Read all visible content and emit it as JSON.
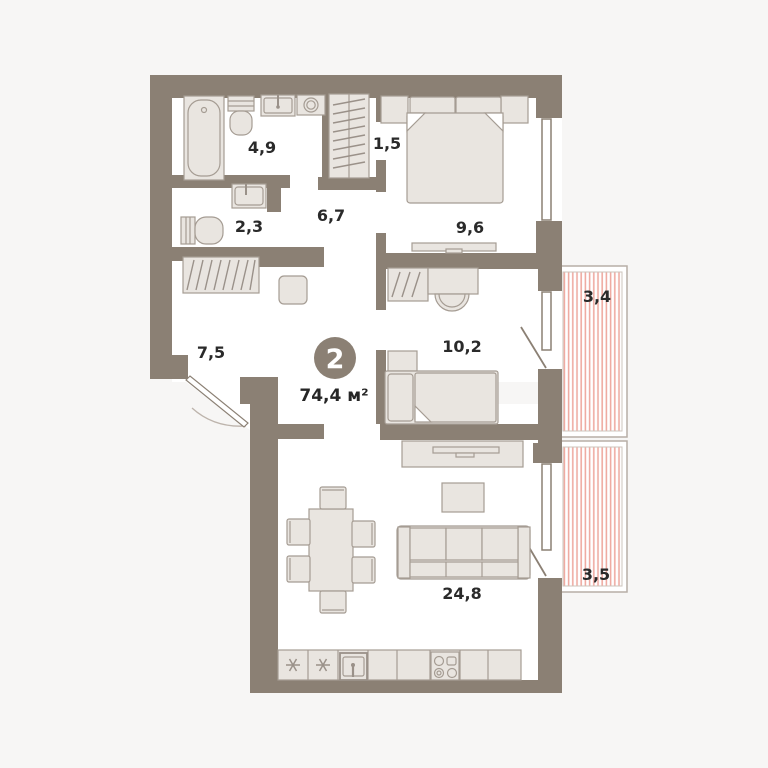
{
  "plan": {
    "badge_number": "2",
    "total_area": "74,4 м²",
    "rooms": [
      {
        "name": "bathroom",
        "area_label": "4,9"
      },
      {
        "name": "closet",
        "area_label": "1,5"
      },
      {
        "name": "wc",
        "area_label": "2,3"
      },
      {
        "name": "corridor",
        "area_label": "6,7"
      },
      {
        "name": "bedroom",
        "area_label": "9,6"
      },
      {
        "name": "hallway",
        "area_label": "7,5"
      },
      {
        "name": "kids-room",
        "area_label": "10,2"
      },
      {
        "name": "living-kitchen",
        "area_label": "24,8"
      },
      {
        "name": "loggia-upper",
        "area_label": "3,4"
      },
      {
        "name": "loggia-lower",
        "area_label": "3,5"
      }
    ],
    "colors": {
      "background": "#f7f6f5",
      "wall": "#8b8074",
      "room_fill": "#ffffff",
      "furniture_fill": "#e9e5e0",
      "furniture_stroke": "#a59c93",
      "loggia_stripe": "#efaba2",
      "label_text": "#2a2a2a",
      "badge_fill": "#8b8074",
      "badge_text": "#ffffff"
    }
  }
}
